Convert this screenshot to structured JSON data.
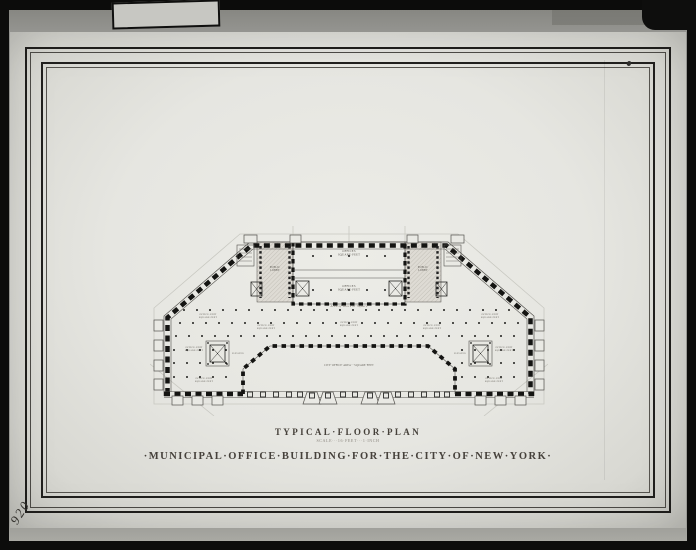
{
  "photo": {
    "negative_number": "920",
    "colors": {
      "frame_black": "#0c0c0b",
      "surface_gray": "#94948f",
      "paper": "#e7e7e2",
      "ink": "#161614"
    }
  },
  "sheet": {
    "title_block": {
      "plan_title": "TYPICAL·FLOOR·PLAN",
      "scale_note": "SCALE···16·FEET···1·INCH",
      "drawing_title": "·MUNICIPAL·OFFICE·BUILDING·FOR·THE·CITY·OF·NEW·YORK·"
    }
  },
  "plan": {
    "labels": [
      {
        "name": "offices-top",
        "x": 199,
        "y": 26,
        "size": 3,
        "lines": [
          "OFFICES",
          "SQUARE·FEET"
        ]
      },
      {
        "name": "offices-bottom",
        "x": 199,
        "y": 61,
        "size": 3,
        "lines": [
          "OFFICES",
          "SQUARE·FEET"
        ]
      },
      {
        "name": "public-lobby-left",
        "x": 125,
        "y": 42,
        "size": 2.6,
        "lines": [
          "PUBLIC",
          "LOBBY"
        ]
      },
      {
        "name": "public-lobby-right",
        "x": 273,
        "y": 42,
        "size": 2.6,
        "lines": [
          "PUBLIC",
          "LOBBY"
        ]
      },
      {
        "name": "office-unit-upper-left",
        "x": 58,
        "y": 89,
        "size": 2.4,
        "lines": [
          "OFFICE·UNIT",
          "SQUARE·FEET"
        ]
      },
      {
        "name": "office-unit-upper-right",
        "x": 340,
        "y": 89,
        "size": 2.4,
        "lines": [
          "OFFICE·UNIT",
          "SQUARE·FEET"
        ]
      },
      {
        "name": "office-unit-mid-left",
        "x": 116,
        "y": 100,
        "size": 2.4,
        "lines": [
          "OFFICE·UNIT",
          "SQUARE·FEET"
        ]
      },
      {
        "name": "office-unit-mid-center",
        "x": 199,
        "y": 97,
        "size": 2.4,
        "lines": [
          "OFFICE·UNIT",
          "SQUARE·FEET"
        ]
      },
      {
        "name": "office-unit-mid-right",
        "x": 282,
        "y": 100,
        "size": 2.4,
        "lines": [
          "OFFICE·UNIT",
          "SQUARE·FEET"
        ]
      },
      {
        "name": "office-unit-low-left",
        "x": 44,
        "y": 122,
        "size": 2.4,
        "lines": [
          "OFFICE·UNIT",
          "SQUARE·FEET"
        ]
      },
      {
        "name": "office-unit-low-right",
        "x": 354,
        "y": 122,
        "size": 2.4,
        "lines": [
          "OFFICE·UNIT",
          "SQUARE·FEET"
        ]
      },
      {
        "name": "office-unit-bottom-left",
        "x": 54,
        "y": 153,
        "size": 2.4,
        "lines": [
          "OFFICE·UNIT",
          "SQUARE·FEET"
        ]
      },
      {
        "name": "office-unit-bottom-right",
        "x": 344,
        "y": 153,
        "size": 2.4,
        "lines": [
          "OFFICE·UNIT",
          "SQUARE·FEET"
        ]
      },
      {
        "name": "city-office-area",
        "x": 199,
        "y": 140,
        "size": 2.6,
        "lines": [
          "CITY·OFFICE·AREA···SQUARE·FEET"
        ]
      },
      {
        "name": "script-annotation",
        "x": 199,
        "y": 81,
        "size": 3.4,
        "italic": true,
        "lines": [
          "·Area·of·Block·or·Square·"
        ]
      },
      {
        "name": "elevator-left",
        "x": 88,
        "y": 128,
        "size": 2,
        "lines": [
          "ELEVATOR"
        ]
      },
      {
        "name": "elevator-right",
        "x": 310,
        "y": 128,
        "size": 2,
        "lines": [
          "ELEVATOR"
        ]
      }
    ]
  }
}
